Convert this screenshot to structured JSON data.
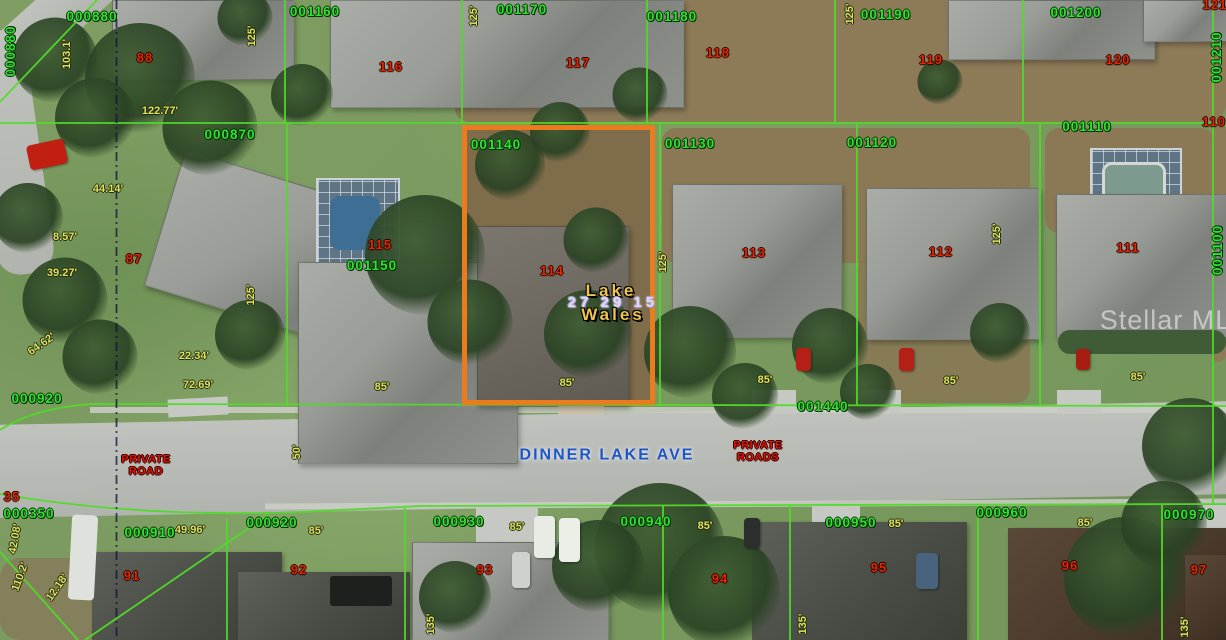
{
  "image_type": "aerial parcel map",
  "watermark": "Stellar MLS",
  "street": {
    "label": "DINNER LAKE AVE",
    "x": 607,
    "y": 456
  },
  "road_notes": [
    {
      "line1": "PRIVATE",
      "line2": "ROAD",
      "x": 146,
      "y": 466
    },
    {
      "line1": "PRIVATE",
      "line2": "ROADS",
      "x": 758,
      "y": 452
    }
  ],
  "highlight": {
    "parcel_id": "001140",
    "lot": "114",
    "color": "#ec7b1e",
    "box": {
      "x": 462,
      "y": 125,
      "w": 193,
      "h": 280
    },
    "overlay": [
      {
        "text": "Lake",
        "style": "gold",
        "x": 611,
        "y": 291
      },
      {
        "text": "27 29 15",
        "style": "lavender",
        "x": 613,
        "y": 303
      },
      {
        "text": "Wales",
        "style": "gold",
        "x": 613,
        "y": 315
      }
    ]
  },
  "parcel_labels": [
    {
      "text": "000880",
      "x": 11,
      "y": 51,
      "rot": -90
    },
    {
      "text": "000880",
      "x": 92,
      "y": 17
    },
    {
      "text": "001160",
      "x": 315,
      "y": 12
    },
    {
      "text": "001170",
      "x": 522,
      "y": 10
    },
    {
      "text": "001180",
      "x": 672,
      "y": 17
    },
    {
      "text": "001190",
      "x": 886,
      "y": 15
    },
    {
      "text": "001200",
      "x": 1076,
      "y": 13
    },
    {
      "text": "001210",
      "x": 1217,
      "y": 57,
      "rot": -90
    },
    {
      "text": "000870",
      "x": 230,
      "y": 135
    },
    {
      "text": "001140",
      "x": 496,
      "y": 145
    },
    {
      "text": "001130",
      "x": 690,
      "y": 144
    },
    {
      "text": "001120",
      "x": 872,
      "y": 143
    },
    {
      "text": "001110",
      "x": 1087,
      "y": 127
    },
    {
      "text": "001100",
      "x": 1218,
      "y": 250,
      "rot": -90
    },
    {
      "text": "001150",
      "x": 372,
      "y": 266
    },
    {
      "text": "000920",
      "x": 37,
      "y": 399
    },
    {
      "text": "001440",
      "x": 823,
      "y": 407
    },
    {
      "text": "000350",
      "x": 29,
      "y": 514
    },
    {
      "text": "000910",
      "x": 150,
      "y": 533
    },
    {
      "text": "000920",
      "x": 272,
      "y": 523
    },
    {
      "text": "000930",
      "x": 459,
      "y": 522
    },
    {
      "text": "000940",
      "x": 646,
      "y": 522
    },
    {
      "text": "000950",
      "x": 851,
      "y": 523
    },
    {
      "text": "000960",
      "x": 1002,
      "y": 513
    },
    {
      "text": "000970",
      "x": 1189,
      "y": 515
    }
  ],
  "lot_numbers": [
    {
      "text": "88",
      "x": 145,
      "y": 58
    },
    {
      "text": "116",
      "x": 391,
      "y": 67
    },
    {
      "text": "117",
      "x": 578,
      "y": 63
    },
    {
      "text": "118",
      "x": 718,
      "y": 53
    },
    {
      "text": "119",
      "x": 931,
      "y": 60
    },
    {
      "text": "120",
      "x": 1118,
      "y": 60
    },
    {
      "text": "121",
      "x": 1215,
      "y": 5
    },
    {
      "text": "110",
      "x": 1214,
      "y": 122
    },
    {
      "text": "87",
      "x": 134,
      "y": 259
    },
    {
      "text": "115",
      "x": 380,
      "y": 245
    },
    {
      "text": "114",
      "x": 552,
      "y": 271
    },
    {
      "text": "113",
      "x": 754,
      "y": 253
    },
    {
      "text": "112",
      "x": 941,
      "y": 252
    },
    {
      "text": "111",
      "x": 1128,
      "y": 248
    },
    {
      "text": "35",
      "x": 12,
      "y": 497
    },
    {
      "text": "91",
      "x": 132,
      "y": 576
    },
    {
      "text": "92",
      "x": 299,
      "y": 570
    },
    {
      "text": "93",
      "x": 485,
      "y": 570
    },
    {
      "text": "94",
      "x": 720,
      "y": 579
    },
    {
      "text": "95",
      "x": 879,
      "y": 568
    },
    {
      "text": "96",
      "x": 1070,
      "y": 566
    },
    {
      "text": "97",
      "x": 1199,
      "y": 570
    }
  ],
  "dimension_labels": [
    {
      "text": "122.77'",
      "x": 160,
      "y": 112
    },
    {
      "text": "103.1'",
      "x": 68,
      "y": 54,
      "rot": -90
    },
    {
      "text": "125'",
      "x": 253,
      "y": 36,
      "rot": -90
    },
    {
      "text": "125'",
      "x": 475,
      "y": 16,
      "rot": -90
    },
    {
      "text": "125'",
      "x": 851,
      "y": 14,
      "rot": -90
    },
    {
      "text": "44.14'",
      "x": 108,
      "y": 190
    },
    {
      "text": "8.57'",
      "x": 65,
      "y": 238
    },
    {
      "text": "39.27'",
      "x": 62,
      "y": 274
    },
    {
      "text": "64.62'",
      "x": 42,
      "y": 345,
      "rot": -35
    },
    {
      "text": "22.34'",
      "x": 194,
      "y": 357
    },
    {
      "text": "72.69'",
      "x": 198,
      "y": 386
    },
    {
      "text": "125'",
      "x": 252,
      "y": 295,
      "rot": -90
    },
    {
      "text": "125'",
      "x": 664,
      "y": 262,
      "rot": -90
    },
    {
      "text": "125'",
      "x": 998,
      "y": 234,
      "rot": -90
    },
    {
      "text": "85'",
      "x": 382,
      "y": 388
    },
    {
      "text": "85'",
      "x": 567,
      "y": 384
    },
    {
      "text": "85'",
      "x": 765,
      "y": 381
    },
    {
      "text": "85'",
      "x": 951,
      "y": 382
    },
    {
      "text": "85'",
      "x": 1138,
      "y": 378
    },
    {
      "text": "50'",
      "x": 298,
      "y": 452,
      "rot": -90
    },
    {
      "text": "49.96'",
      "x": 190,
      "y": 531
    },
    {
      "text": "85'",
      "x": 316,
      "y": 532
    },
    {
      "text": "85'",
      "x": 517,
      "y": 528
    },
    {
      "text": "85'",
      "x": 705,
      "y": 527
    },
    {
      "text": "85'",
      "x": 896,
      "y": 525
    },
    {
      "text": "85'",
      "x": 1085,
      "y": 524
    },
    {
      "text": "42.08'",
      "x": 16,
      "y": 539,
      "rot": -80
    },
    {
      "text": "110.2'",
      "x": 21,
      "y": 577,
      "rot": -70
    },
    {
      "text": "12.18'",
      "x": 58,
      "y": 588,
      "rot": -55
    },
    {
      "text": "135'",
      "x": 432,
      "y": 624,
      "rot": -90
    },
    {
      "text": "135'",
      "x": 804,
      "y": 624,
      "rot": -90
    },
    {
      "text": "135'",
      "x": 1186,
      "y": 627,
      "rot": -90
    }
  ],
  "colors": {
    "highlight_orange": "#ec7b1e",
    "boundary_green": "#50dc28",
    "parcel_label_green": "#2fe22f",
    "lot_number_red": "#e22800",
    "dimension_yellow": "#dde45f",
    "street_blue": "#1d55c8",
    "private_road_red": "#e21405",
    "survey_line_navy": "#10103a"
  }
}
